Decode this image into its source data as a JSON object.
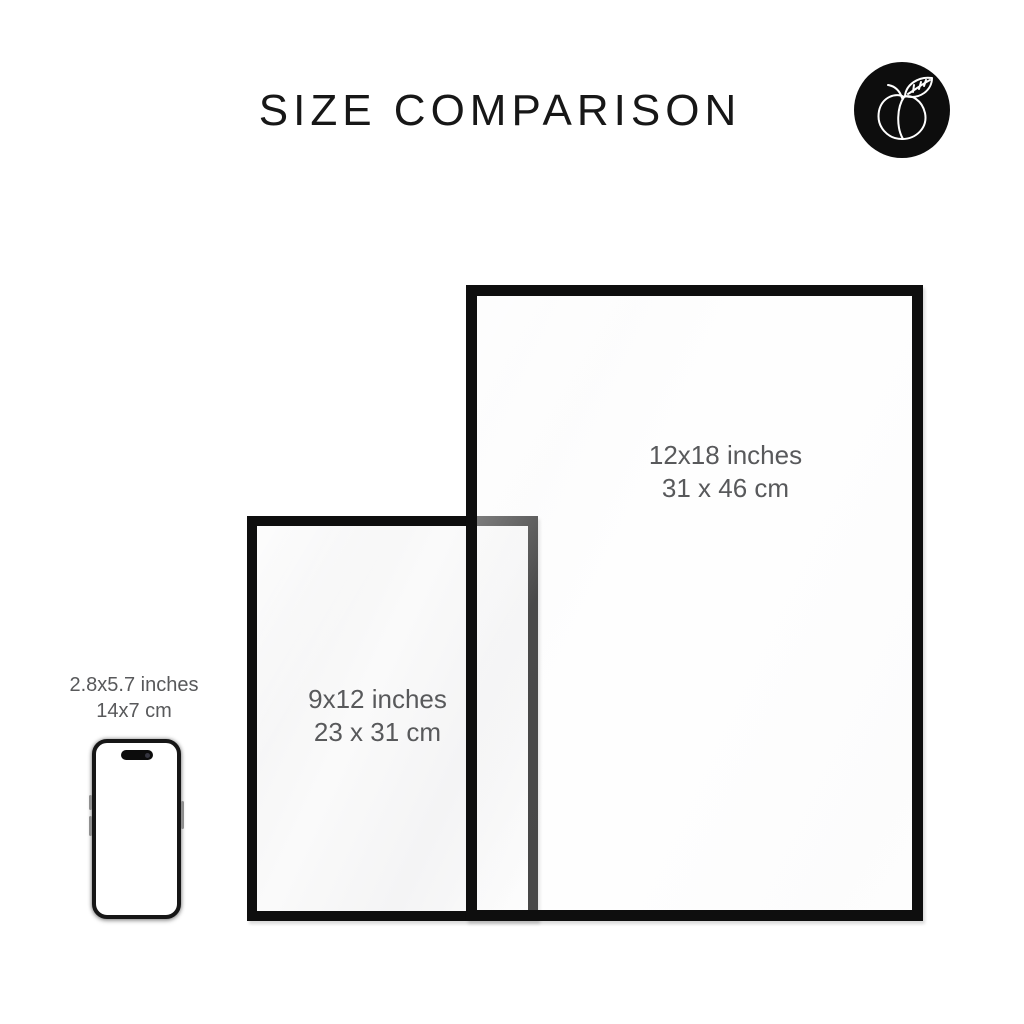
{
  "title": "SIZE COMPARISON",
  "badge": {
    "icon": "peach-icon"
  },
  "frames": {
    "large": {
      "size_in": "12x18 inches",
      "size_cm": "31 x 46 cm"
    },
    "small": {
      "size_in": "9x12 inches",
      "size_cm": "23 x 31 cm"
    }
  },
  "phone": {
    "size_in": "2.8x5.7 inches",
    "size_cm": "14x7 cm"
  },
  "colors": {
    "background": "#ffffff",
    "frame_border": "#0e0e0e",
    "label_text": "#58595b",
    "title_text": "#171717",
    "badge_bg": "#0d0d0d",
    "badge_line": "#ffffff"
  }
}
